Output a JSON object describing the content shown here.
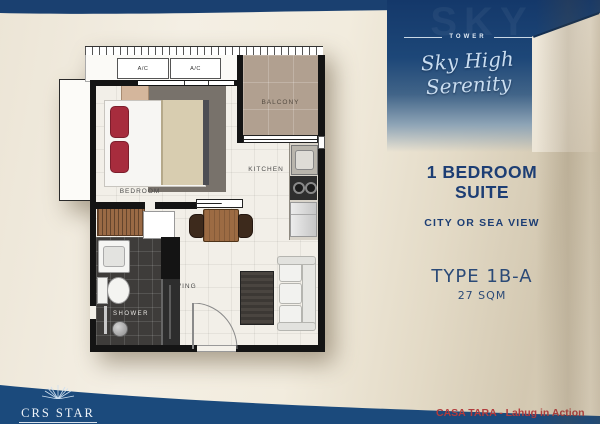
{
  "banner": {
    "tower_label": "TOWER",
    "script_title": "Sky High Serenity",
    "watermark": "SKY"
  },
  "unit": {
    "title_line1": "1 BEDROOM",
    "title_line2": "SUITE",
    "view": "CITY OR SEA VIEW",
    "type": "TYPE 1B-A",
    "area": "27 SQM"
  },
  "floorplan": {
    "labels": {
      "bedroom": "BEDROOM",
      "kitchen": "KITCHEN",
      "living": "LIVING",
      "shower": "SHOWER",
      "balcony": "BALCONY"
    },
    "ac_units": [
      "A/C",
      "A/C"
    ]
  },
  "footer": {
    "brand": "CRS STAR",
    "tagline": "CASA TARA - Lahug in Action"
  },
  "colors": {
    "navy": "#1b4474",
    "cream": "#f0e9dc",
    "title_text": "#1d3e74",
    "accent_red": "#b23b3c",
    "balcony_tan": "#b1a090",
    "bath_dark": "#3e3c3a"
  }
}
